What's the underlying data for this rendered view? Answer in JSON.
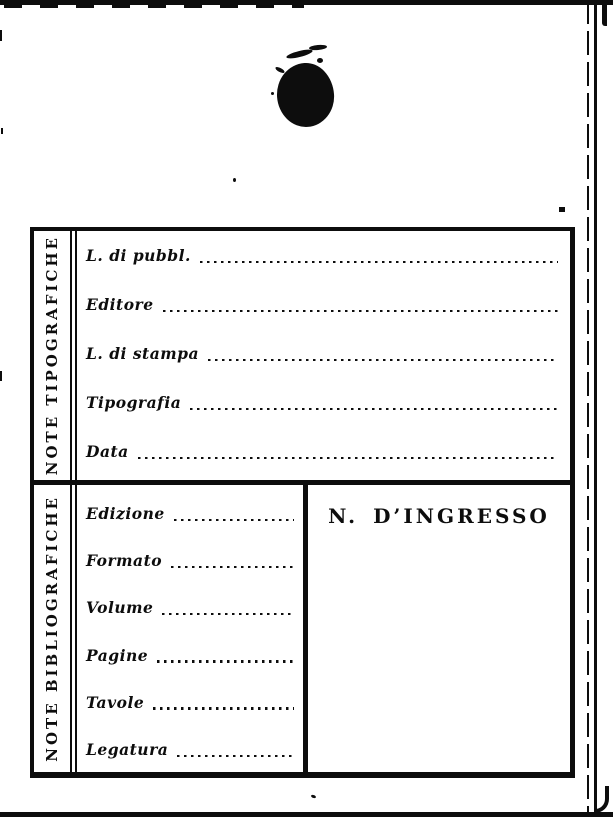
{
  "colors": {
    "ink": "#0d0d0d",
    "paper": "#ffffff"
  },
  "typographic_section": {
    "header": "NOTE TIPOGRAFICHE",
    "fields": [
      {
        "label": "L. di pubbl.",
        "value": ""
      },
      {
        "label": "Editore",
        "value": ""
      },
      {
        "label": "L. di stampa",
        "value": ""
      },
      {
        "label": "Tipografia",
        "value": ""
      },
      {
        "label": "Data",
        "value": ""
      }
    ]
  },
  "bibliographic_section": {
    "header": "NOTE BIBLIOGRAFICHE",
    "fields": [
      {
        "label": "Edizione",
        "value": ""
      },
      {
        "label": "Formato",
        "value": ""
      },
      {
        "label": "Volume",
        "value": ""
      },
      {
        "label": "Pagine",
        "value": ""
      },
      {
        "label": "Tavole",
        "value": ""
      },
      {
        "label": "Legatura",
        "value": ""
      }
    ]
  },
  "ingresso_box": {
    "label": "N. D’INGRESSO",
    "value": ""
  }
}
